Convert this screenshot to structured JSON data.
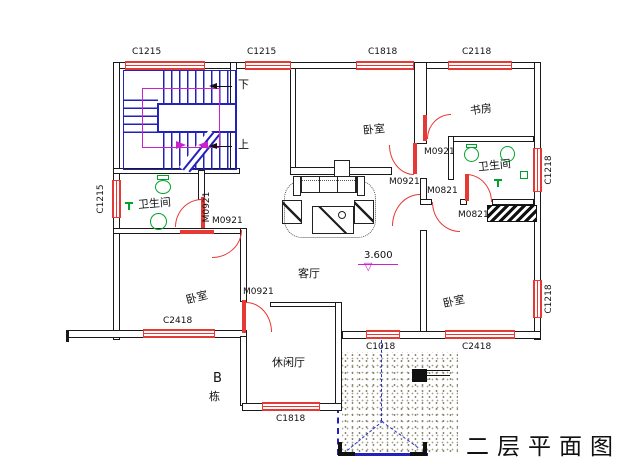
{
  "title": "二层平面图",
  "block": {
    "line1": "B",
    "line2": "栋"
  },
  "elevation": {
    "value": "3.600"
  },
  "stairs": {
    "down": "下",
    "up": "上"
  },
  "rooms": {
    "bedroom_top": "卧室",
    "study": "书房",
    "bath_right": "卫生间",
    "bath_left": "卫生间",
    "living": "客厅",
    "bedroom_left": "卧室",
    "leisure": "休闲厅",
    "bedroom_right": "卧室"
  },
  "windows": {
    "c1215_top_left": "C1215",
    "c1215_top_mid": "C1215",
    "c1818_top": "C1818",
    "c2118_top": "C2118",
    "c1215_left": "C1215",
    "c1218_right_upper": "C1218",
    "c1218_right_lower": "C1218",
    "c2418_bottom_left": "C2418",
    "c1018_bottom_mid": "C1018",
    "c2418_bottom_right": "C2418",
    "c1818_bottom": "C1818"
  },
  "doors": {
    "m0921_top": "M0921",
    "m0921_hall": "M0921",
    "m0821_bedroom": "M0821",
    "m0821_bath": "M0821",
    "m0921_bath_left": "M0921",
    "m0921_vestibule": "M0921",
    "m0921_bedroom_left": "M0921"
  },
  "colors": {
    "wall": "#1a1a1a",
    "window_door": "#e53935",
    "stair": "#2222bb",
    "fixture": "#00a32a",
    "guide": "#cc22cc"
  }
}
